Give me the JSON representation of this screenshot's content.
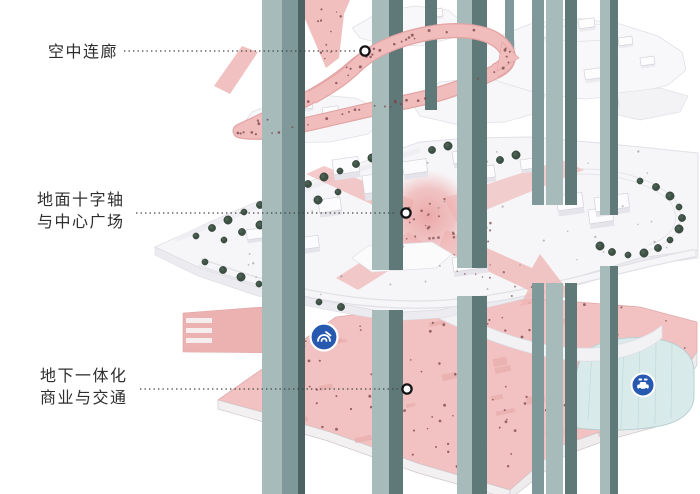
{
  "diagram": {
    "type": "axonometric-architecture-levels-diagram",
    "annotations": [
      {
        "id": "sky-corridor",
        "lines": [
          "空中连廊"
        ]
      },
      {
        "id": "ground-cross-axis",
        "lines": [
          "地面十字轴",
          "与中心广场"
        ]
      },
      {
        "id": "underground-hub",
        "lines": [
          "地下一体化",
          "商业与交通"
        ]
      }
    ],
    "icons": [
      {
        "name": "metro-icon"
      },
      {
        "name": "parking-icon"
      }
    ],
    "colors": {
      "corridor_pink": "#f1bcbc",
      "axis_pink": "#efb3b3",
      "underground_pink": "#f2c1c1",
      "column_teal": "#a6bbba",
      "column_teal_mid": "#7f9899",
      "column_teal_dark": "#5f7878",
      "column_teal_deep": "#4c6263",
      "tree_green": "#3d5044",
      "transit_blue": "#2859b0",
      "parking_teal": "#d9eaea",
      "label_text": "#2e2e2e"
    }
  }
}
